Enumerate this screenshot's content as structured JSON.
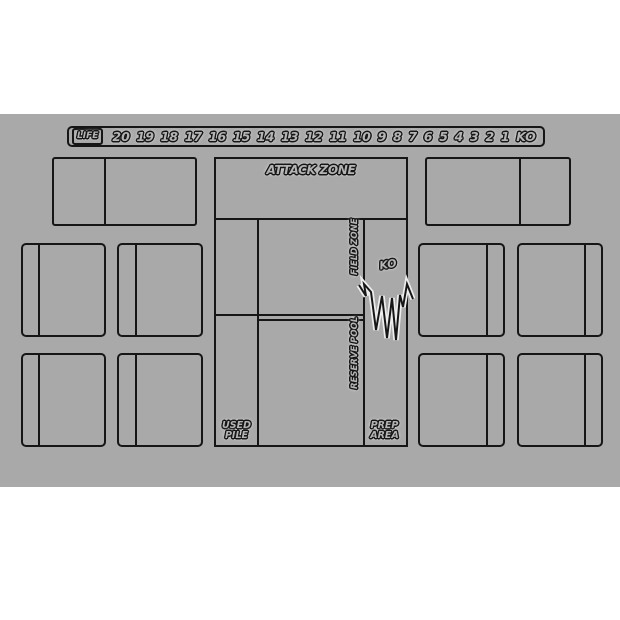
{
  "mat": {
    "life_track": {
      "label": "LIFE",
      "values": [
        "20",
        "19",
        "18",
        "17",
        "16",
        "15",
        "14",
        "13",
        "12",
        "11",
        "10",
        "9",
        "8",
        "7",
        "6",
        "5",
        "4",
        "3",
        "2",
        "1",
        "KO"
      ]
    },
    "center": {
      "attack_zone": "ATTACK ZONE",
      "field_zone": "FIELD ZONE",
      "reserve_pool": "RESERVE POOL",
      "ko": "KO",
      "used_pile": {
        "line1": "USED",
        "line2": "PILE"
      },
      "prep_area": {
        "line1": "PREP",
        "line2": "AREA"
      }
    },
    "colors": {
      "page": "#ffffff",
      "mat": "#a9a9a9",
      "line": "#161616",
      "text_fill": "#b4b4b4",
      "burst_halo": "#ededed"
    }
  }
}
